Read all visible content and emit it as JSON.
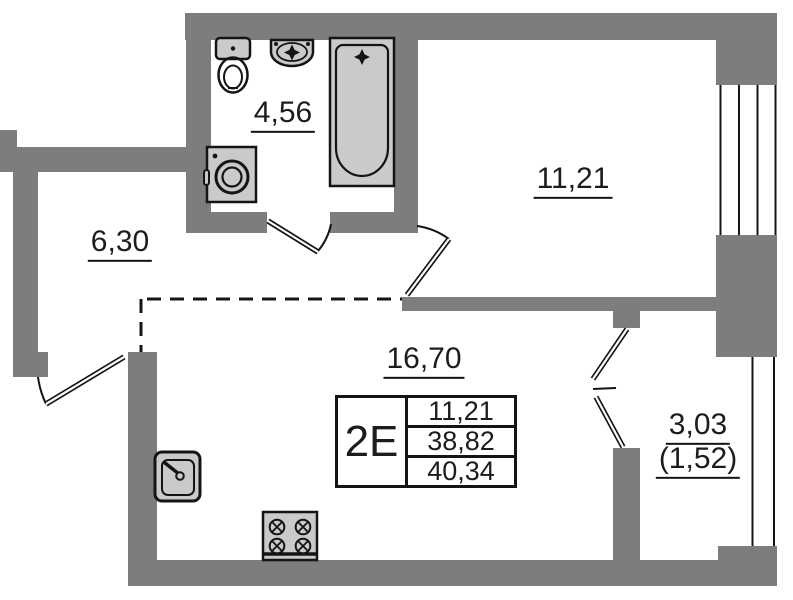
{
  "title": "apartment-floor-plan",
  "colors": {
    "wall": "#7d7d7d",
    "fixture": "#cacaca",
    "line": "#141414",
    "text": "#1c1c1c"
  },
  "rooms": {
    "bathroom": {
      "area": "4,56"
    },
    "hallway": {
      "area": "6,30"
    },
    "bedroom": {
      "area": "11,21"
    },
    "living": {
      "area": "16,70"
    },
    "balcony": {
      "area": "3,03",
      "area_reduced": "(1,52)"
    }
  },
  "summary_table": {
    "type": "2E",
    "rows": [
      "11,21",
      "38,82",
      "40,34"
    ]
  },
  "fixtures": [
    "toilet",
    "wash-basin",
    "bathtub",
    "washing-machine",
    "kitchen-sink",
    "stove"
  ]
}
